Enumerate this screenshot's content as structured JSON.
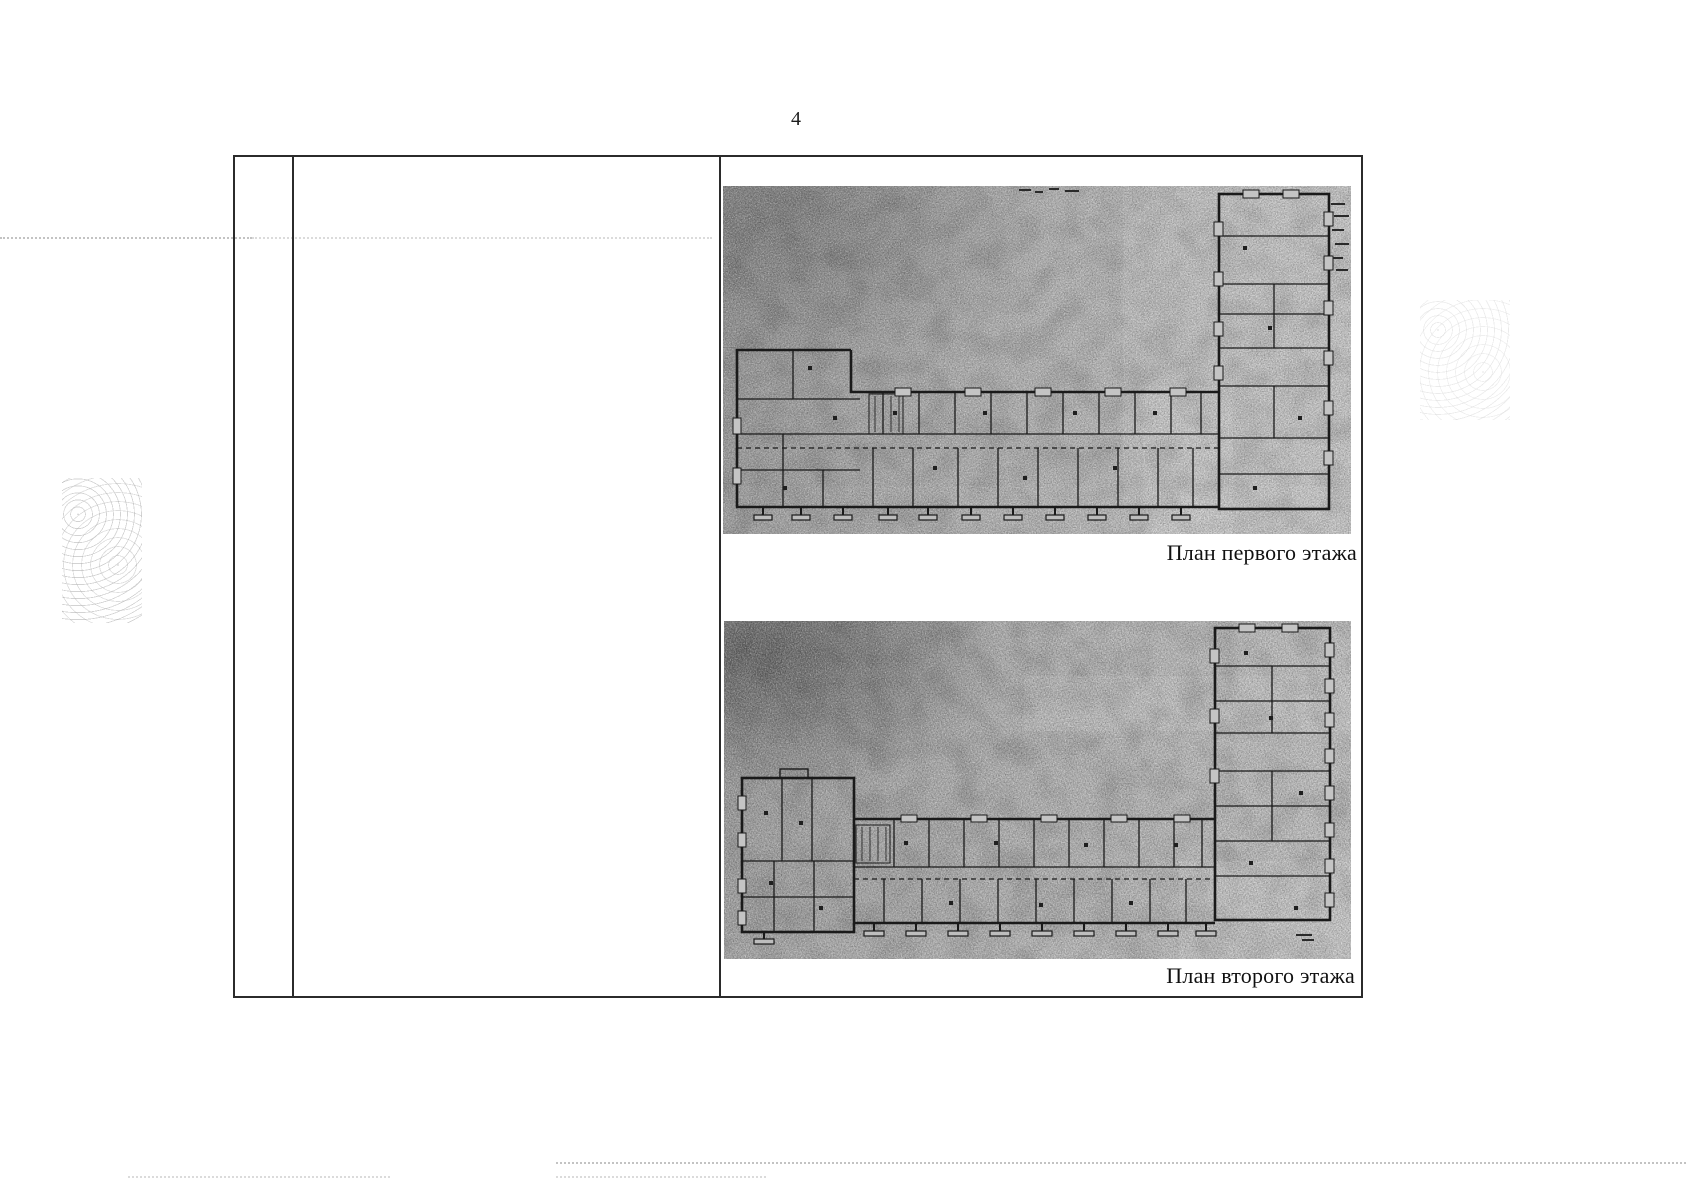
{
  "page": {
    "number": "4",
    "background_color": "#ffffff"
  },
  "table": {
    "columns": 3,
    "border_color": "#2b2b2b"
  },
  "figures": [
    {
      "id": "first-floor-plan",
      "caption": "План первого этажа"
    },
    {
      "id": "second-floor-plan",
      "caption": "План второго этажа"
    }
  ],
  "colors": {
    "scan_ink": "#1a1a1a",
    "figure_gray": "#b2b2b2",
    "figure_dark_gray": "#6f6f6f",
    "figure_light_gray": "#c7c7c7",
    "caption_text": "#101010"
  }
}
